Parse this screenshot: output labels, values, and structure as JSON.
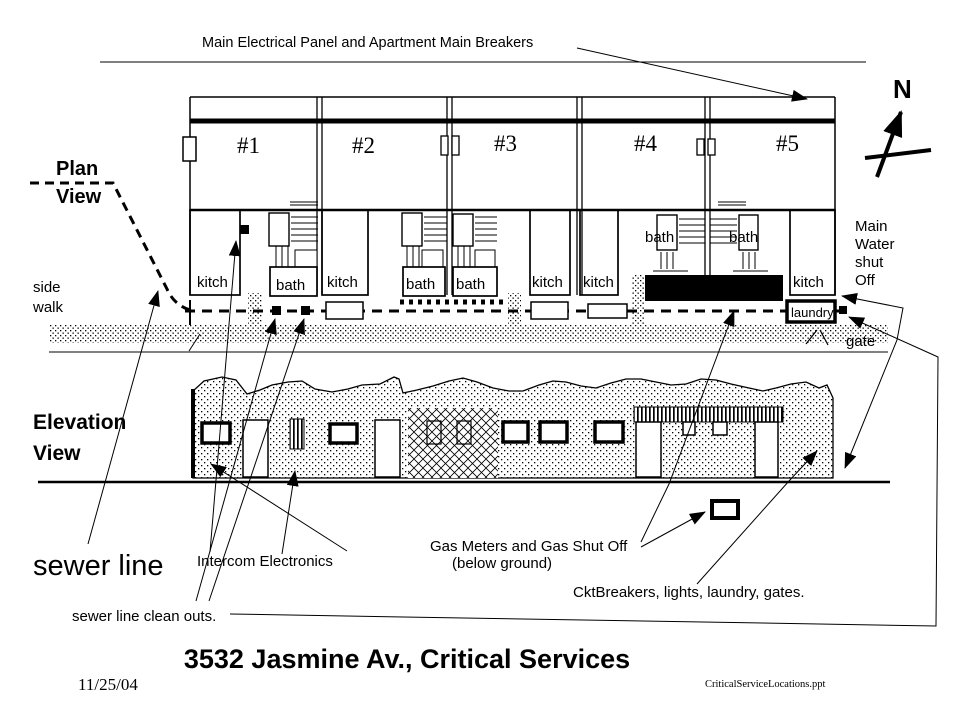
{
  "slide": {
    "title": "3532 Jasmine Av., Critical Services",
    "date": "11/25/04",
    "filename": "CriticalServiceLocations.ppt"
  },
  "annotations": {
    "main_panel": "Main Electrical Panel and Apartment Main Breakers",
    "sewer_line": "sewer line",
    "sewer_cleanouts": "sewer line clean outs.",
    "intercom": "Intercom Electronics",
    "gas_line1": "Gas Meters and Gas Shut Off",
    "gas_line2": "(below ground)",
    "ckt_breakers": "CktBreakers, lights, laundry, gates.",
    "gate": "gate",
    "compass_north": "N"
  },
  "plan": {
    "label_line1": "Plan",
    "label_line2": "View",
    "sidewalk_line1": "side",
    "sidewalk_line2": "walk",
    "water_line1": "Main",
    "water_line2": "Water",
    "water_line3": "shut",
    "water_line4": "Off",
    "laundry": "laundry",
    "units": [
      {
        "number": "#1"
      },
      {
        "number": "#2"
      },
      {
        "number": "#3"
      },
      {
        "number": "#4"
      },
      {
        "number": "#5"
      }
    ],
    "rooms": [
      {
        "id": "kitch-1",
        "label": "kitch"
      },
      {
        "id": "bath-1",
        "label": "bath"
      },
      {
        "id": "kitch-2",
        "label": "kitch"
      },
      {
        "id": "bath-2",
        "label": "bath"
      },
      {
        "id": "bath-3",
        "label": "bath"
      },
      {
        "id": "kitch-3",
        "label": "kitch"
      },
      {
        "id": "kitch-4",
        "label": "kitch"
      },
      {
        "id": "bath-4",
        "label": "bath"
      },
      {
        "id": "bath-5",
        "label": "bath"
      },
      {
        "id": "kitch-5",
        "label": "kitch"
      }
    ]
  },
  "elevation": {
    "label_line1": "Elevation",
    "label_line2": "View"
  },
  "colors": {
    "ink": "#000000",
    "paper": "#ffffff"
  }
}
